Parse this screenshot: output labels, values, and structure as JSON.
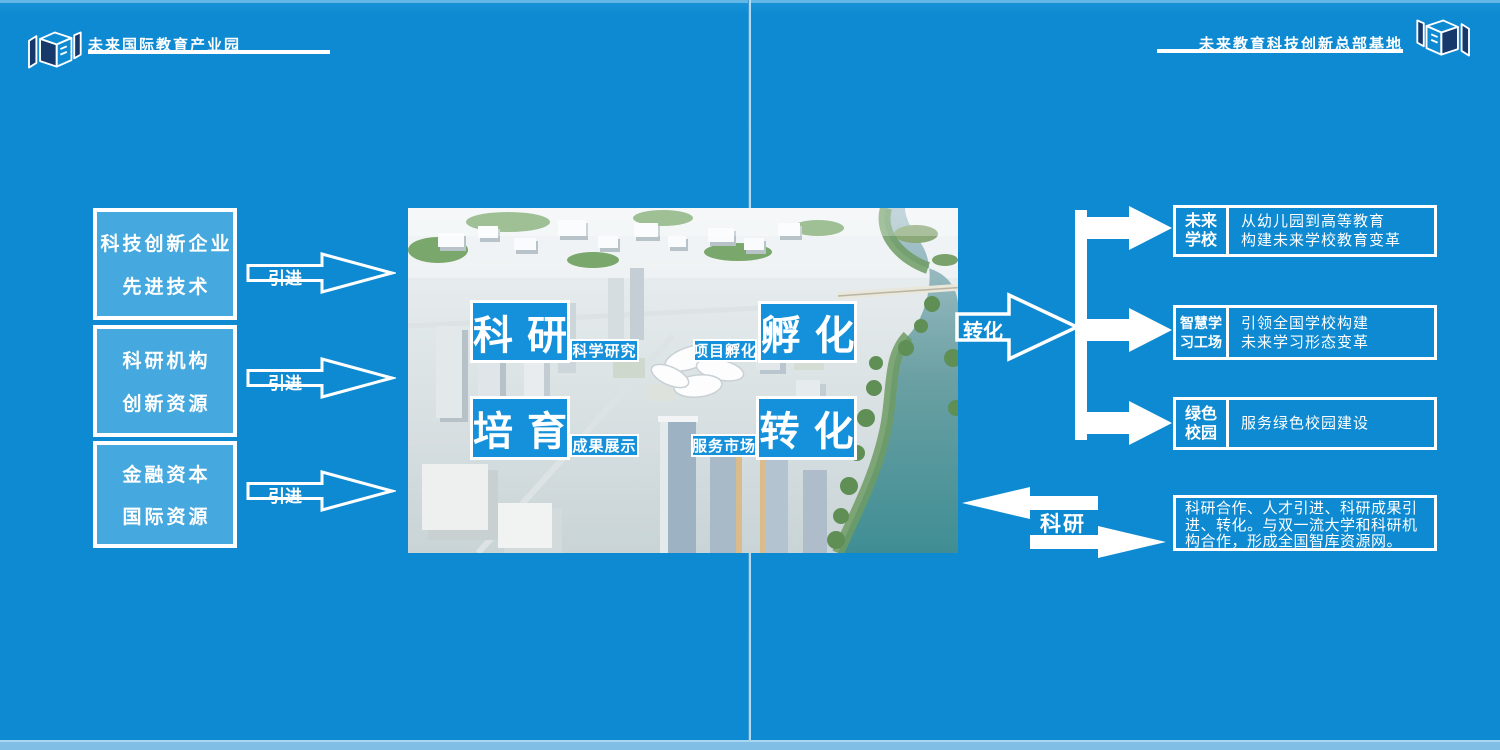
{
  "colors": {
    "background": "#0d8ad1",
    "left_box_fill": "#45a8de",
    "label_box_fill": "#1591db",
    "logo_navy": "#16386b",
    "text": "#ffffff"
  },
  "header_left": {
    "title": "未来国际教育产业园"
  },
  "header_right": {
    "title": "未来教育科技创新总部基地"
  },
  "left_boxes": [
    {
      "line1": "科技创新企业",
      "line2": "先进技术"
    },
    {
      "line1": "科研机构",
      "line2": "创新资源"
    },
    {
      "line1": "金融资本",
      "line2": "国际资源"
    }
  ],
  "flow_labels": {
    "import": "引进",
    "transform": "转化",
    "research": "科研"
  },
  "center_labels": [
    {
      "title": "科研",
      "tag": "科学研究"
    },
    {
      "title": "孵化",
      "tag": "项目孵化"
    },
    {
      "title": "培育",
      "tag": "成果展示"
    },
    {
      "title": "转化",
      "tag": "服务市场"
    }
  ],
  "right_boxes": [
    {
      "label_line1": "未来",
      "label_line2": "学校",
      "desc_line1": "从幼儿园到高等教育",
      "desc_line2": "构建未来学校教育变革"
    },
    {
      "label_line1": "智慧学",
      "label_line2": "习工场",
      "desc_line1": "引领全国学校构建",
      "desc_line2": "未来学习形态变革"
    },
    {
      "label_line1": "绿色",
      "label_line2": "校园",
      "desc_line1": "服务绿色校园建设",
      "desc_line2": ""
    }
  ],
  "research_note": {
    "line1": "科研合作、人才引进、科研成果引",
    "line2": "进、转化。与双一流大学和科研机",
    "line3": "构合作，形成全国智库资源网。"
  }
}
